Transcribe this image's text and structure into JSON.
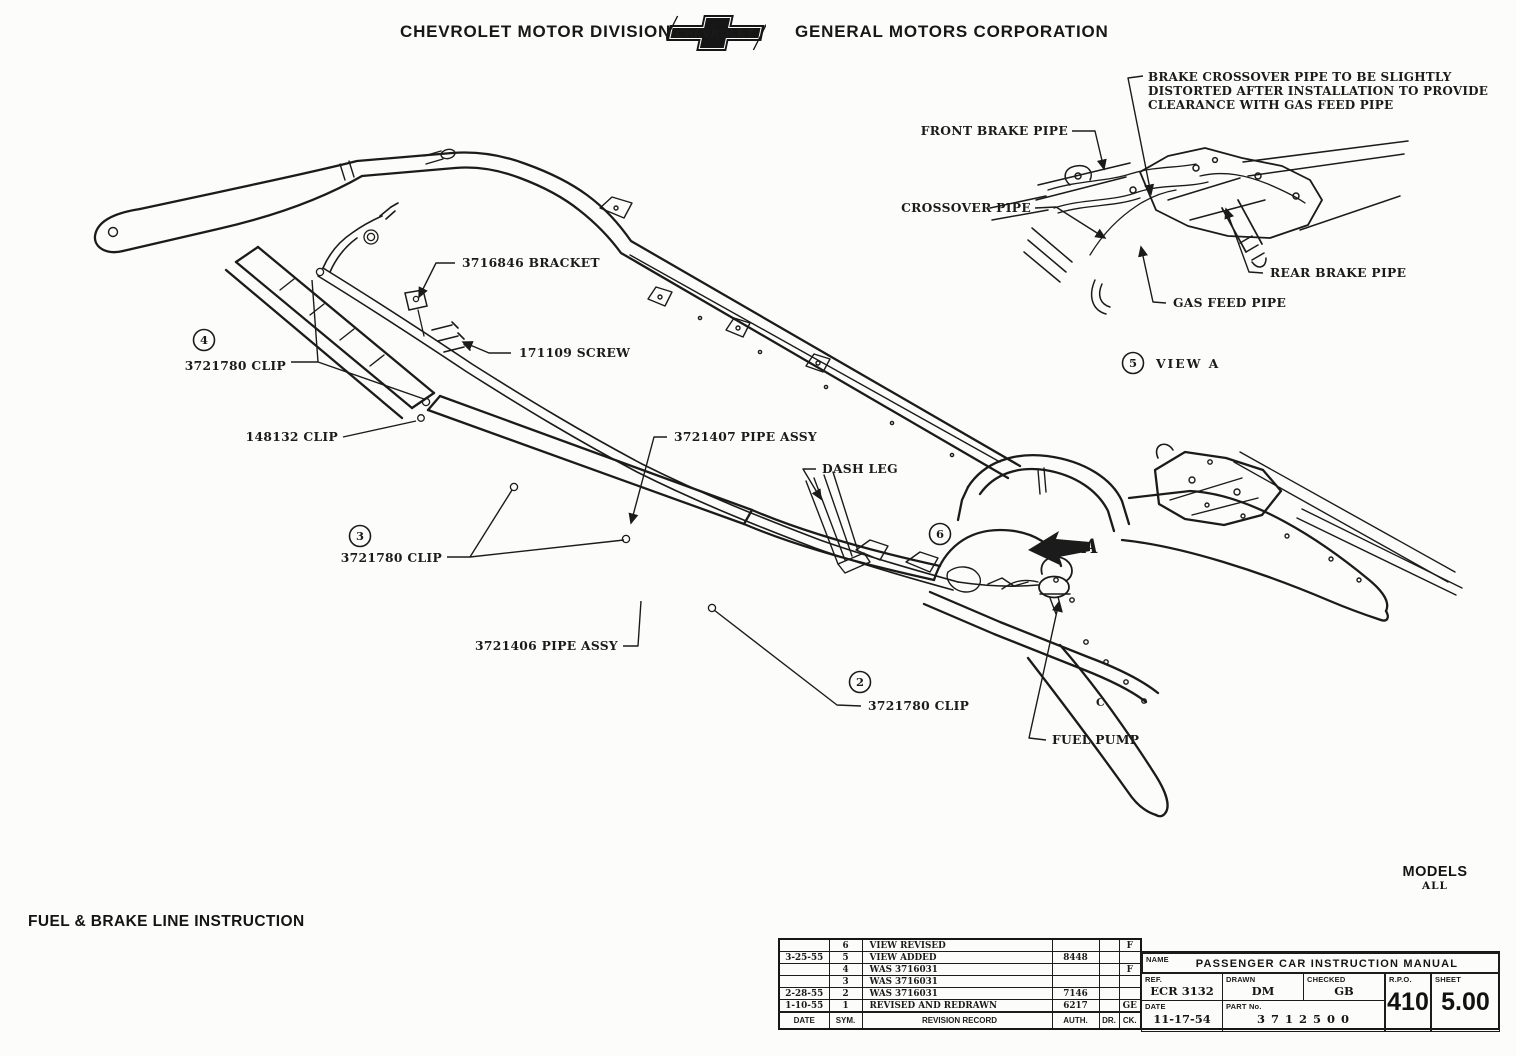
{
  "header": {
    "left": "CHEVROLET MOTOR DIVISION",
    "logo_text": "CHEVROLET",
    "right": "GENERAL MOTORS CORPORATION"
  },
  "footer": {
    "title": "FUEL & BRAKE LINE INSTRUCTION",
    "models_label": "MODELS",
    "models_value": "ALL"
  },
  "diagram": {
    "callouts": [
      {
        "text": "3716846 BRACKET"
      },
      {
        "text": "171109 SCREW"
      },
      {
        "text": "3721780 CLIP"
      },
      {
        "text": "148132 CLIP"
      },
      {
        "text": "3721407 PIPE ASSY"
      },
      {
        "text": "DASH LEG"
      },
      {
        "text": "3721780 CLIP"
      },
      {
        "text": "3721406 PIPE ASSY"
      },
      {
        "text": "3721780 CLIP"
      },
      {
        "text": "FUEL PUMP"
      }
    ],
    "circled_numbers": [
      {
        "n": "4"
      },
      {
        "n": "3"
      },
      {
        "n": "2"
      },
      {
        "n": "6"
      }
    ],
    "direction_arrow_label": "A",
    "frame_letter": "C",
    "view_a": {
      "number": "5",
      "caption": "VIEW A",
      "note_lines": [
        "BRAKE CROSSOVER PIPE TO BE SLIGHTLY",
        "DISTORTED AFTER INSTALLATION TO PROVIDE",
        "CLEARANCE WITH GAS FEED PIPE"
      ],
      "callouts": [
        {
          "text": "FRONT BRAKE PIPE"
        },
        {
          "text": "CROSSOVER PIPE"
        },
        {
          "text": "REAR BRAKE PIPE"
        },
        {
          "text": "GAS FEED PIPE"
        }
      ]
    }
  },
  "revision_table": {
    "headers": [
      "DATE",
      "SYM.",
      "REVISION RECORD",
      "AUTH.",
      "DR.",
      "CK."
    ],
    "rows": [
      [
        "",
        "6",
        "VIEW REVISED",
        "",
        "",
        "F"
      ],
      [
        "3-25-55",
        "5",
        "VIEW ADDED",
        "8448",
        "",
        ""
      ],
      [
        "",
        "4",
        "WAS 3716031",
        "",
        "",
        "F"
      ],
      [
        "",
        "3",
        "WAS 3716031",
        "",
        "",
        ""
      ],
      [
        "2-28-55",
        "2",
        "WAS 3716031",
        "7146",
        "",
        ""
      ],
      [
        "1-10-55",
        "1",
        "REVISED AND REDRAWN",
        "6217",
        "",
        "GE"
      ]
    ]
  },
  "title_block": {
    "name_label": "NAME",
    "name": "PASSENGER CAR INSTRUCTION MANUAL",
    "ref_label": "REF.",
    "ref": "ECR 3132",
    "drawn_label": "DRAWN",
    "drawn": "DM",
    "checked_label": "CHECKED",
    "checked": "GB",
    "rpo_label": "R.P.O.",
    "rpo": "410",
    "sheet_label": "SHEET",
    "sheet": "5.00",
    "date_label": "DATE",
    "date": "11-17-54",
    "part_label": "PART No.",
    "part": "3 7 1 2 5 0 0"
  }
}
